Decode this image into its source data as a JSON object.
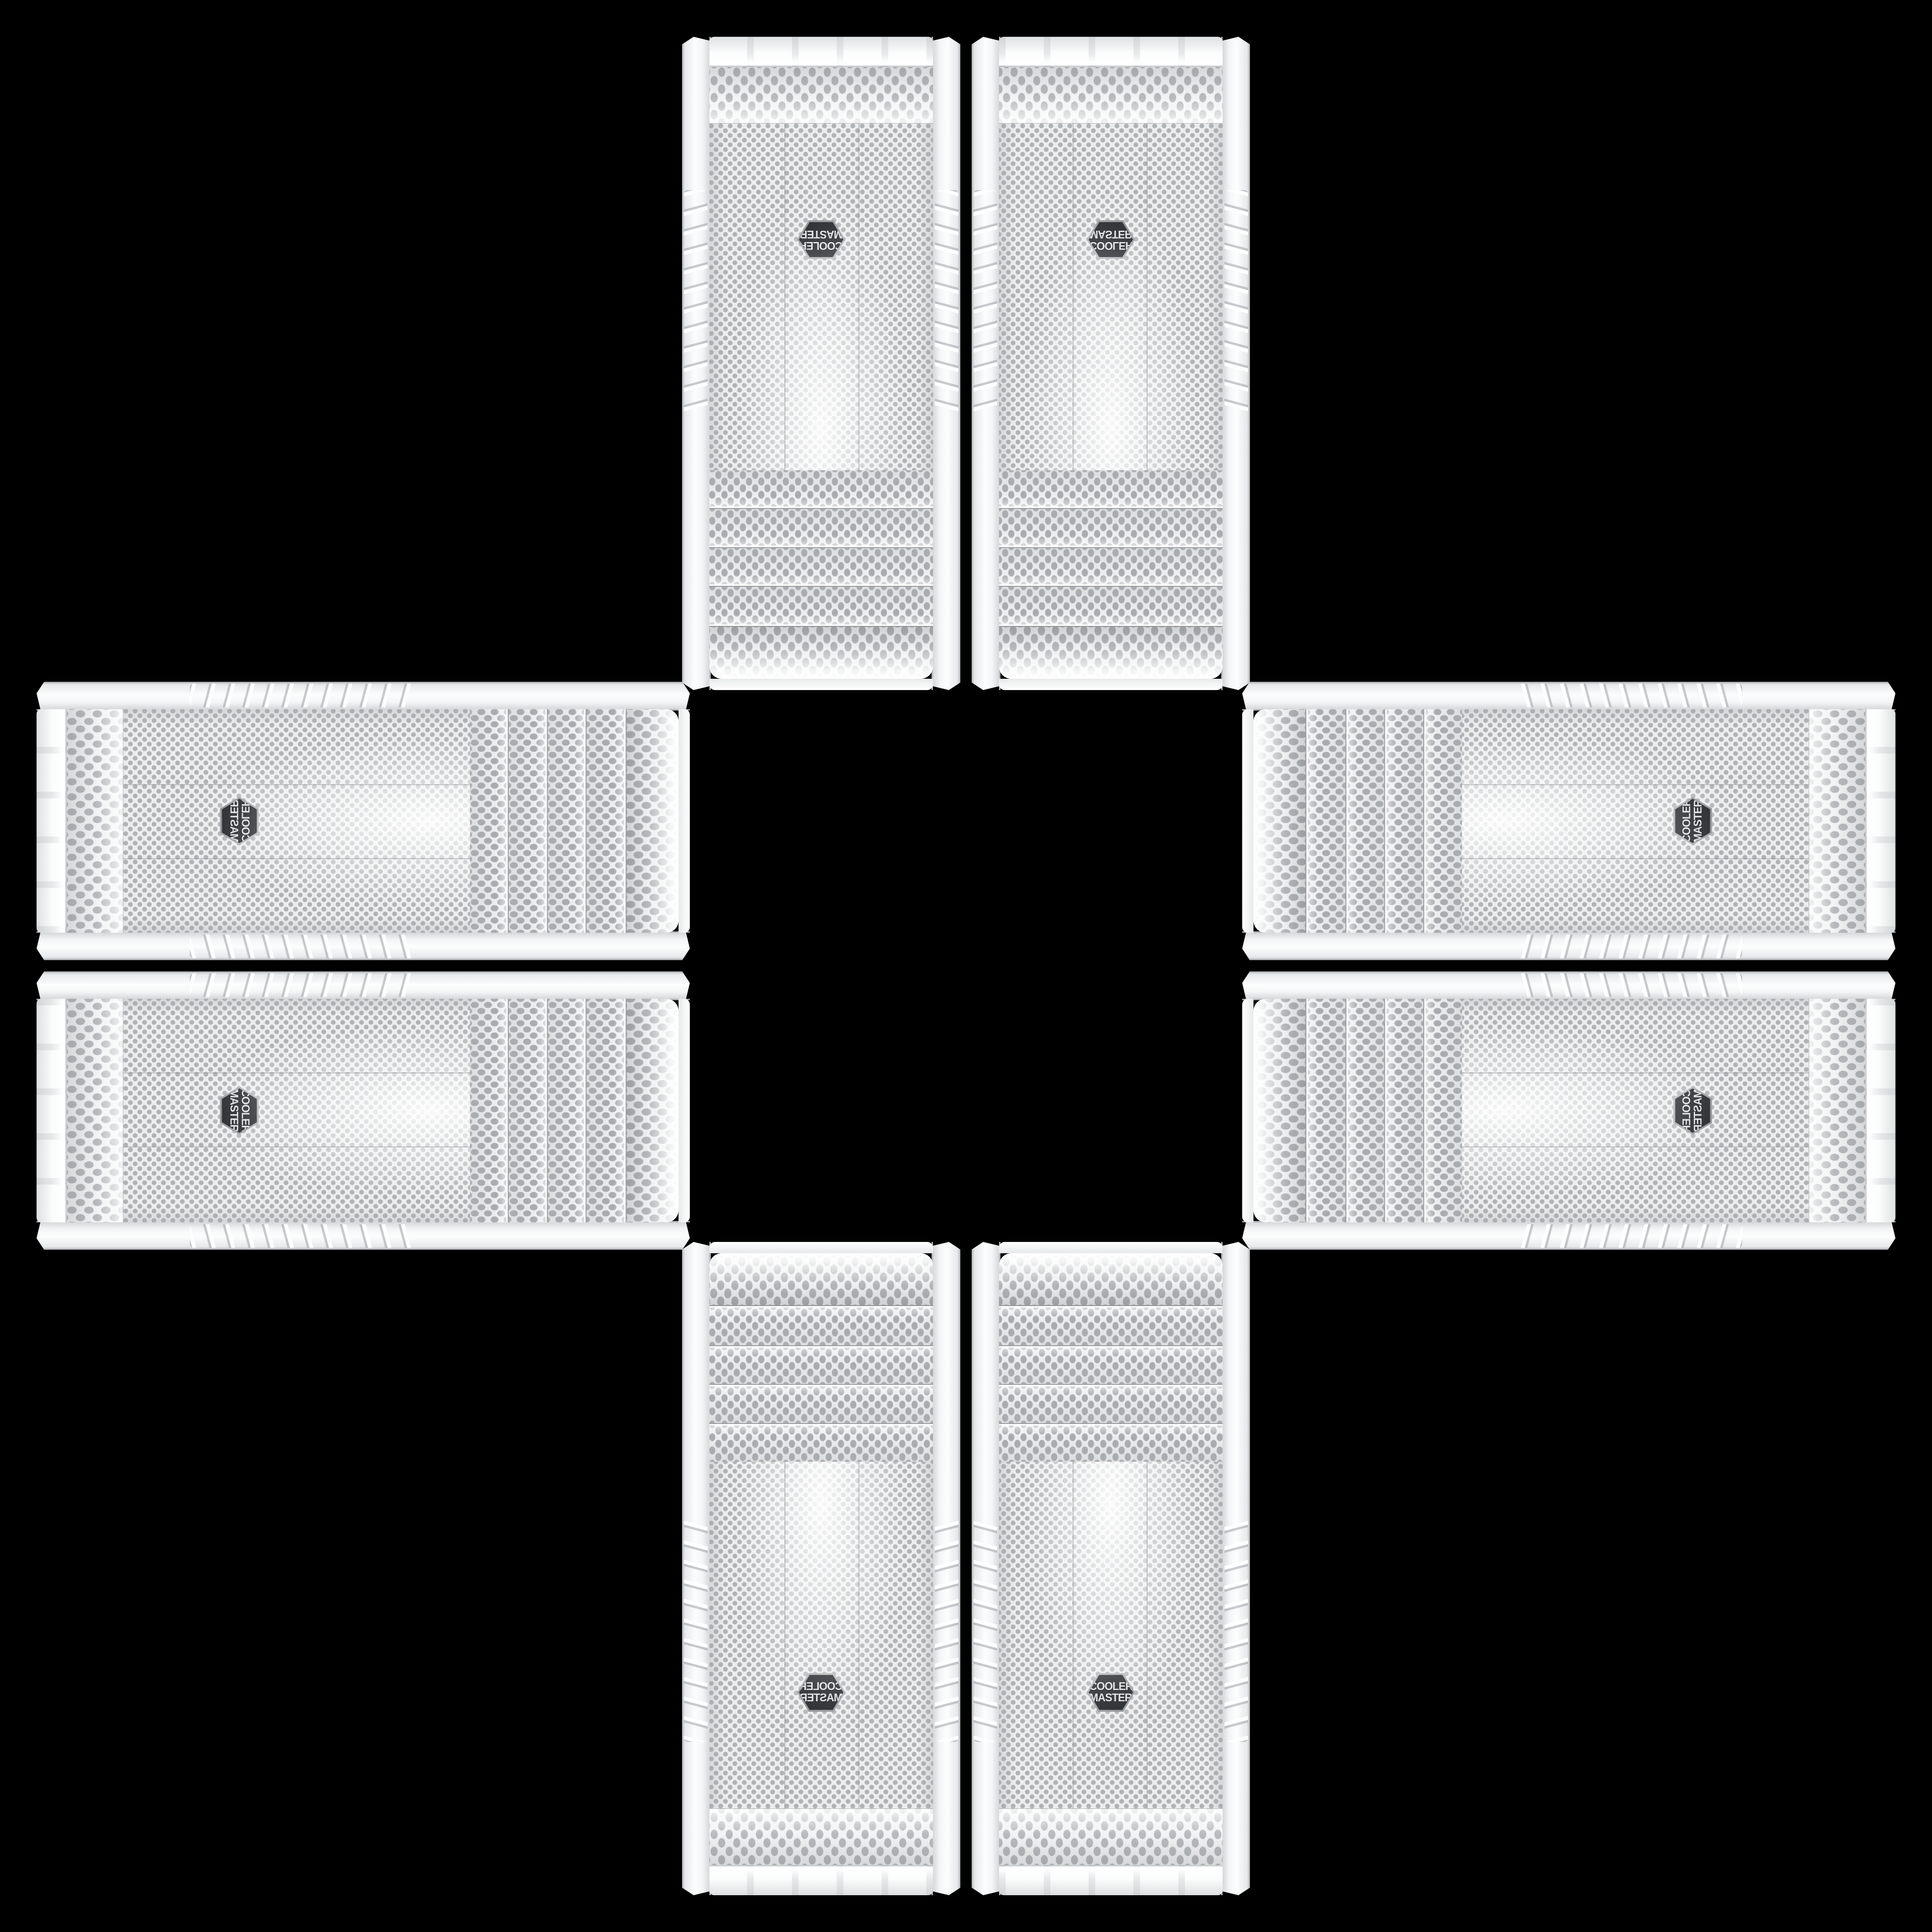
{
  "scene": {
    "description": "Eight identical white Cooler Master mid-tower PC cases photographed front-on, arranged as four mirrored pairs forming a plus/cross shape on a black background",
    "background_color": "#000000",
    "case_count": 8,
    "groups": [
      {
        "name": "top",
        "rotation_deg": 180,
        "css_class": "pos-top"
      },
      {
        "name": "left",
        "rotation_deg": 90,
        "css_class": "pos-left"
      },
      {
        "name": "right",
        "rotation_deg": -90,
        "css_class": "pos-right"
      },
      {
        "name": "bottom",
        "rotation_deg": 0,
        "css_class": "pos-bottom"
      }
    ],
    "pair": {
      "cases_per_pair": 2,
      "first_case_mirrored": true
    }
  },
  "case": {
    "brand": "Cooler Master",
    "product_type": "white mid-tower PC case, front mesh panel",
    "drive_bay_count": 4,
    "badge": {
      "line1": "COOLER",
      "line2": "MASTER",
      "shape": "hexagon",
      "bg_color": "#3c3f42",
      "rim_color": "#caccce",
      "text_color": "#e3e5e6"
    },
    "colors": {
      "body": "#f6f7f8",
      "body_shade": "#d2d5d7",
      "mesh_base": "#eceded",
      "mesh_dot": "#b0b3b6",
      "seam": "#9b9ea1"
    }
  }
}
